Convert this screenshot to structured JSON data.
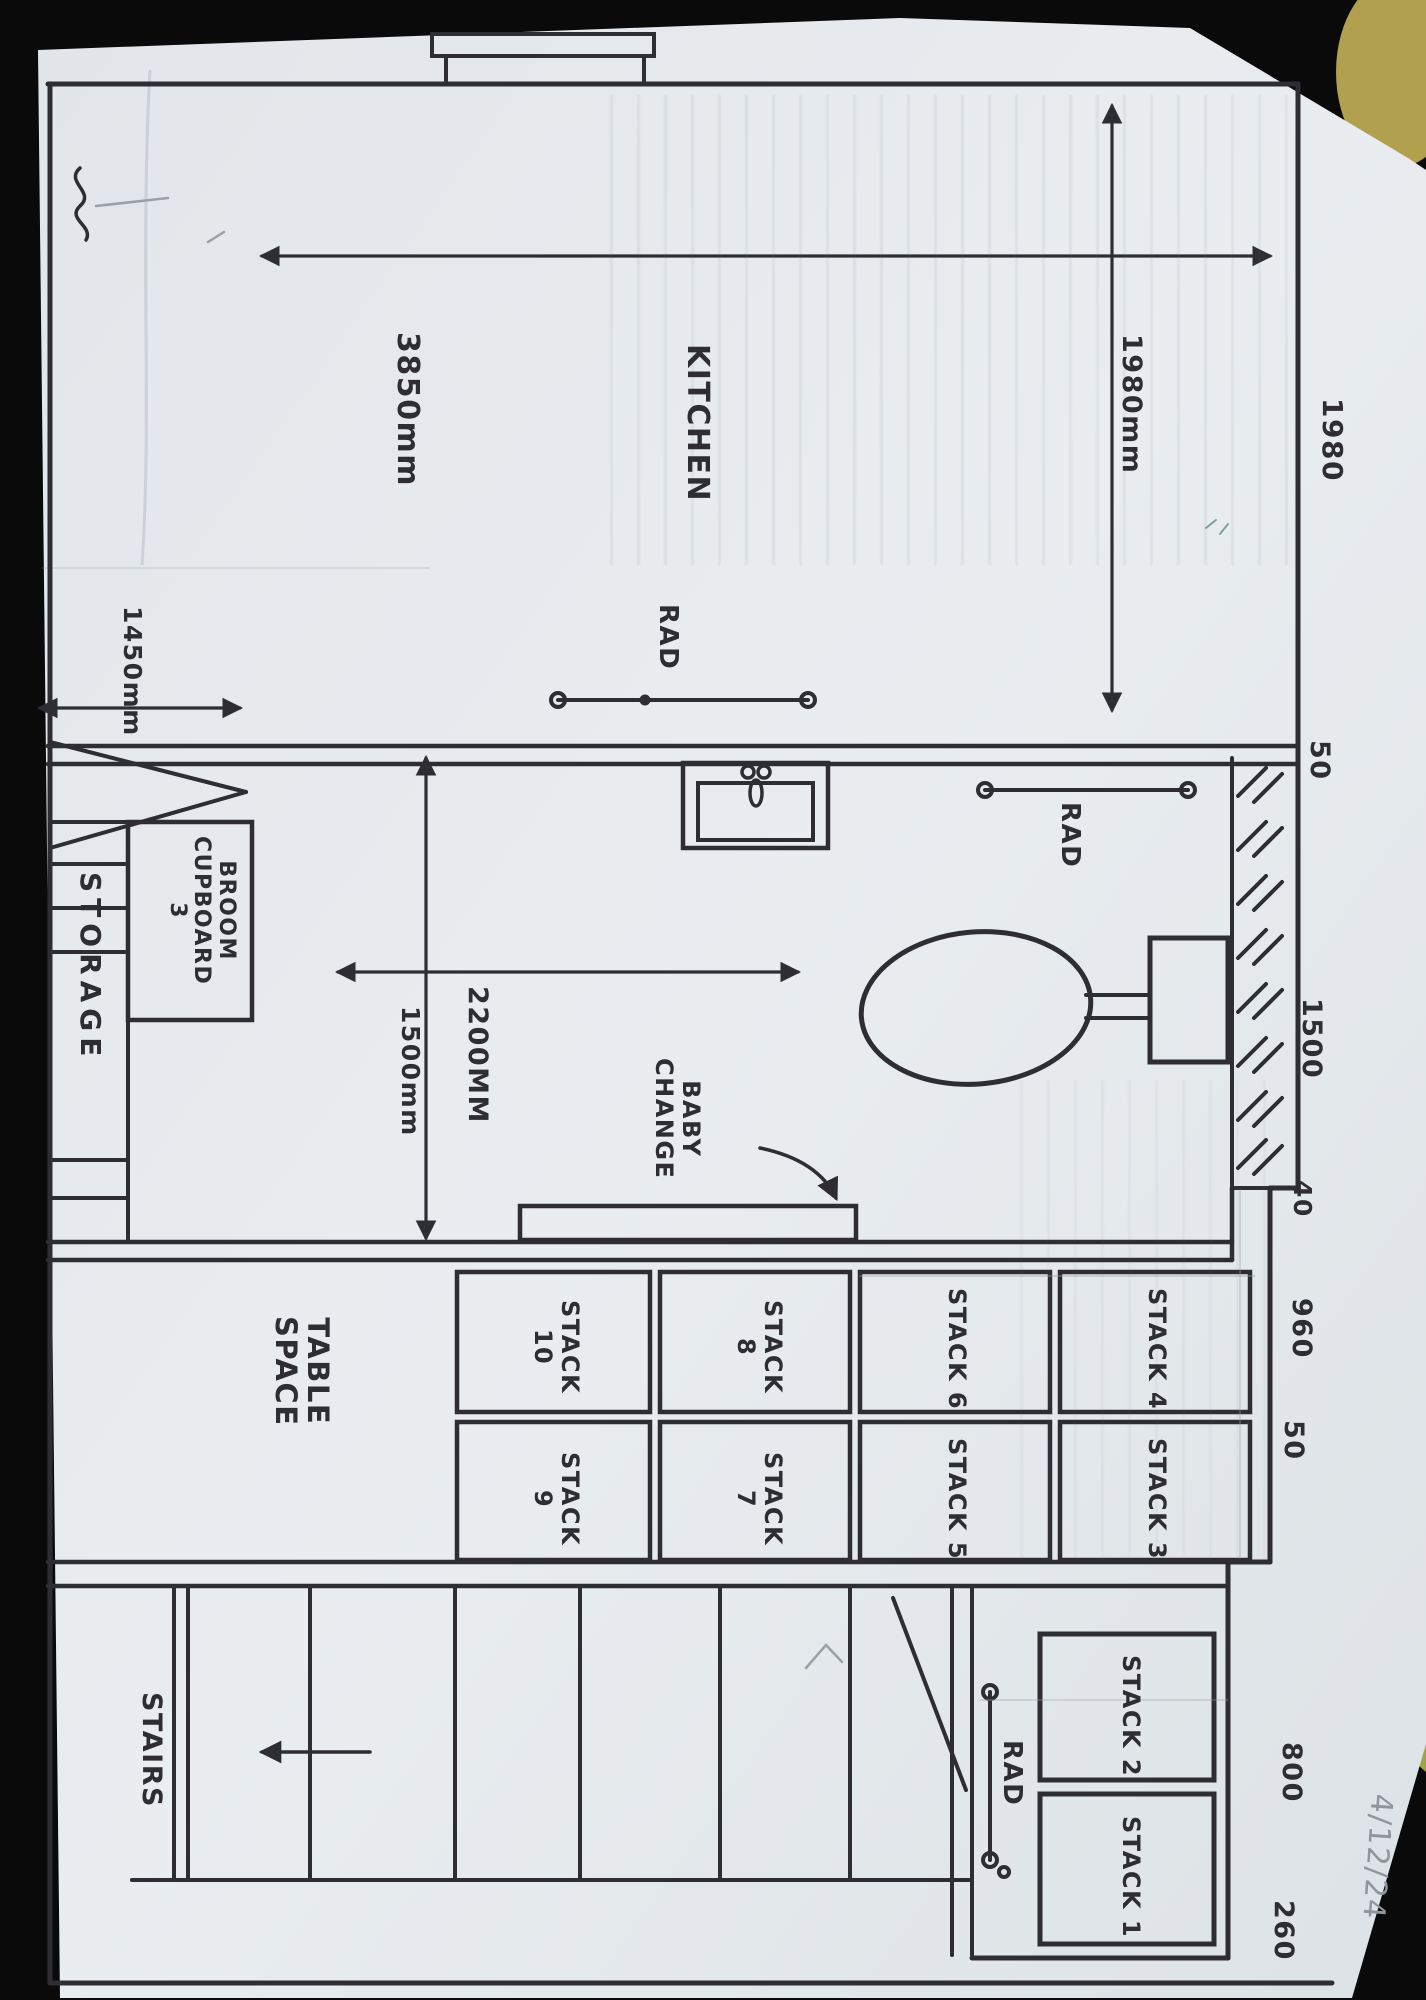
{
  "palette": {
    "background": "#0a0a0b",
    "paper": "#e7ebee",
    "ink": "#2d2d33",
    "pencil": "#8f959b",
    "corner_object": "#b1a04d"
  },
  "rooms": {
    "kitchen": {
      "label": "KITCHEN"
    },
    "table_space": {
      "lines": [
        "TABLE",
        "SPACE"
      ]
    },
    "baby_change": {
      "lines": [
        "BABY",
        "CHANGE"
      ]
    },
    "storage": {
      "label": "STORAGE"
    },
    "broom_cupboard": {
      "lines": [
        "BROOM",
        "CUPBOARD",
        "3"
      ]
    },
    "stairs": {
      "label": "STAIRS"
    }
  },
  "radiators": {
    "kitchen": "RAD",
    "bathroom": "RAD",
    "stairs": "RAD"
  },
  "dimensions": {
    "kitchen_width": "3850mm",
    "kitchen_depth": "1980mm",
    "bathroom_depth": "2200MM",
    "bathroom_width": "1500mm",
    "cupboard_width": "1450mm",
    "right_side_total": "1980",
    "right_side_chain": [
      "50",
      "1500",
      "40",
      "960",
      "50",
      "800",
      "260"
    ]
  },
  "stacks": [
    {
      "id": "stack-10",
      "lines": [
        "STACK",
        "10"
      ]
    },
    {
      "id": "stack-8",
      "lines": [
        "STACK",
        "8"
      ]
    },
    {
      "id": "stack-6",
      "lines": [
        "STACK 6"
      ]
    },
    {
      "id": "stack-4",
      "lines": [
        "STACK 4"
      ]
    },
    {
      "id": "stack-9",
      "lines": [
        "STACK",
        "9"
      ]
    },
    {
      "id": "stack-7",
      "lines": [
        "STACK",
        "7"
      ]
    },
    {
      "id": "stack-5",
      "lines": [
        "STACK 5"
      ]
    },
    {
      "id": "stack-3",
      "lines": [
        "STACK 3"
      ]
    },
    {
      "id": "stack-2",
      "lines": [
        "STACK 2"
      ]
    },
    {
      "id": "stack-1",
      "lines": [
        "STACK 1"
      ]
    }
  ],
  "annotations": {
    "date": "4/12/24"
  }
}
